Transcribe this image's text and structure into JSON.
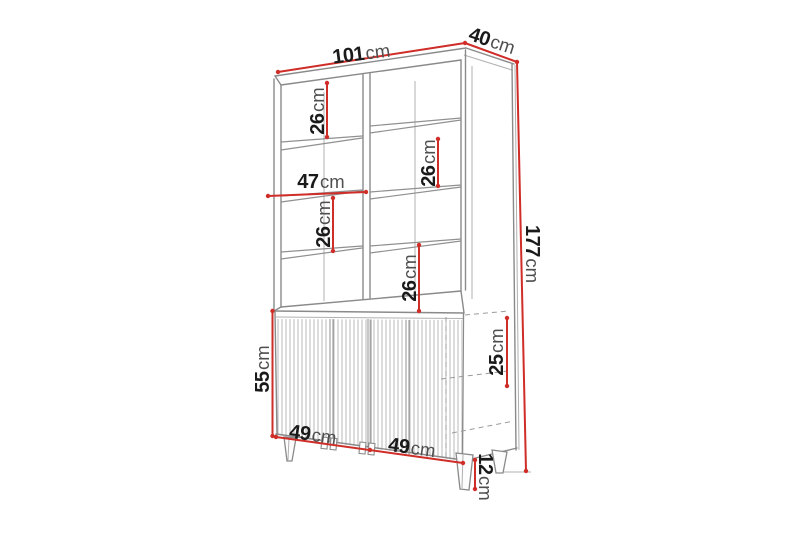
{
  "diagram": {
    "unit": "cm",
    "dimensions": {
      "width": "101",
      "depth": "40",
      "height": "177",
      "inner_width": "47",
      "shelf_gap_left_upper": "26",
      "shelf_gap_left_lower": "26",
      "shelf_gap_right_upper": "26",
      "shelf_gap_right_lower": "26",
      "sideboard_height": "55",
      "side_section_height": "25",
      "door_width_left": "49",
      "door_width_right": "49",
      "leg_height": "12"
    },
    "colors": {
      "dimension_line": "#cf2d28",
      "outline": "#8a8a8a",
      "digit_text": "#1a1a1a",
      "unit_text": "#4f4f4f",
      "background": "#ffffff"
    }
  }
}
